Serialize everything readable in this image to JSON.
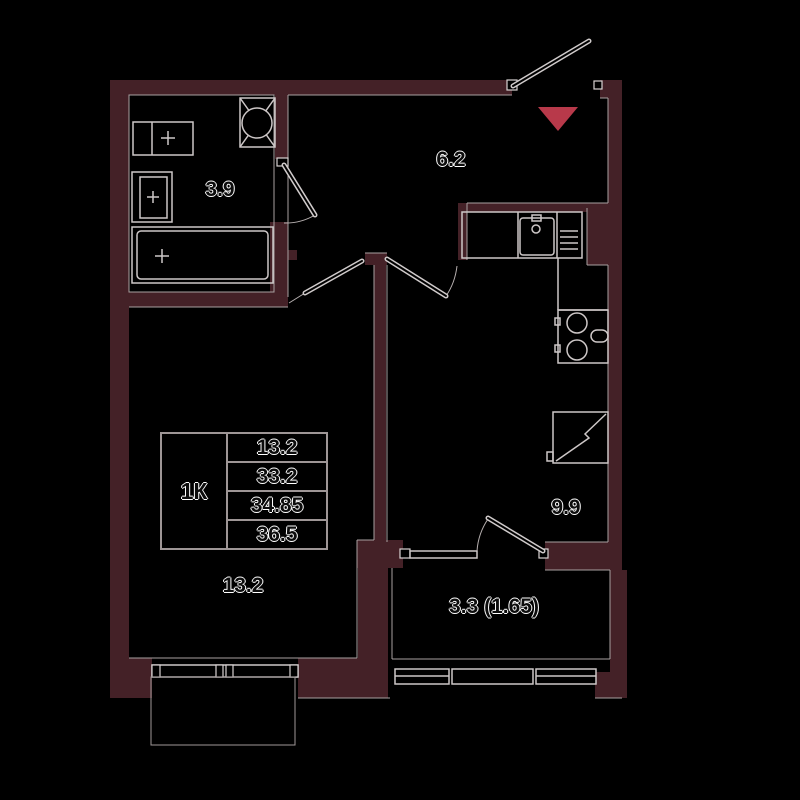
{
  "plan": {
    "rooms": [
      {
        "id": "bathroom",
        "area": "3.9"
      },
      {
        "id": "hallway",
        "area": "6.2"
      },
      {
        "id": "kitchen",
        "area": "9.9"
      },
      {
        "id": "living_room",
        "area": "13.2"
      },
      {
        "id": "balcony",
        "area": "3.3 (1.65)"
      }
    ],
    "info_table": {
      "apartment_type": "1К",
      "values": [
        "13.2",
        "33.2",
        "34.85",
        "36.5"
      ]
    },
    "colors": {
      "wall": "#442127",
      "entrance_marker": "#b8394a",
      "fixture_outline": "#cdc7c7",
      "background": "#000000"
    },
    "icons": {
      "entrance_marker": "triangle-down",
      "vent_shaft": "crossed-box-fan",
      "fixtures": [
        "washing-machine",
        "sink",
        "bathtub",
        "kitchen-sink",
        "stove",
        "fridge"
      ]
    }
  }
}
